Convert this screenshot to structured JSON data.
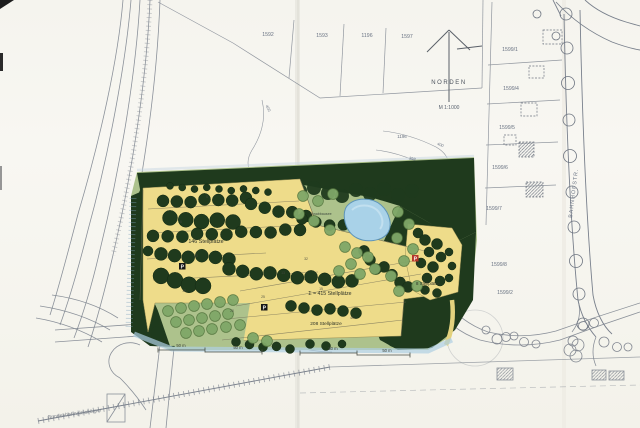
{
  "plan_labels": {
    "north": "NORDEN",
    "scale": "M 1:1000",
    "parking_main": "146 Stellplätze",
    "parking_sum": "Σ = 415 Stellplätze",
    "parking_208": "208 Stellplätze",
    "parking_8": "8 Stellplätze",
    "pond": "Tonabbausee",
    "railway": "Bundesbahngleiskörper",
    "street": "BAHNHOFSTR.",
    "p_sign": "P"
  },
  "parcels": {
    "top": [
      "1592",
      "1593",
      "1196",
      "1597"
    ],
    "right": [
      "1599/1",
      "1599/4",
      "1599/5",
      "1599/6",
      "1599/7",
      "1599/8",
      "1599/2"
    ],
    "center": "1196"
  },
  "contour_labels": [
    "400",
    "398",
    "400"
  ],
  "scale_bar_segments": [
    "50 m",
    "50 m",
    "50 m",
    "50 m"
  ],
  "lot_counts": [
    "5",
    "10",
    "15",
    "20",
    "25",
    "30",
    "32",
    "40",
    "13",
    "8"
  ],
  "colors": {
    "forest": "#1f3a1d",
    "lawn": "#adc28c",
    "parking_yellow": "#eedc8a",
    "pond_blue": "#a9d2e8",
    "pencil_gray": "#79808c",
    "wash_blue": "#aecfe3",
    "p_marker_red": "#b5372b",
    "paper": "#f7f6f1"
  }
}
